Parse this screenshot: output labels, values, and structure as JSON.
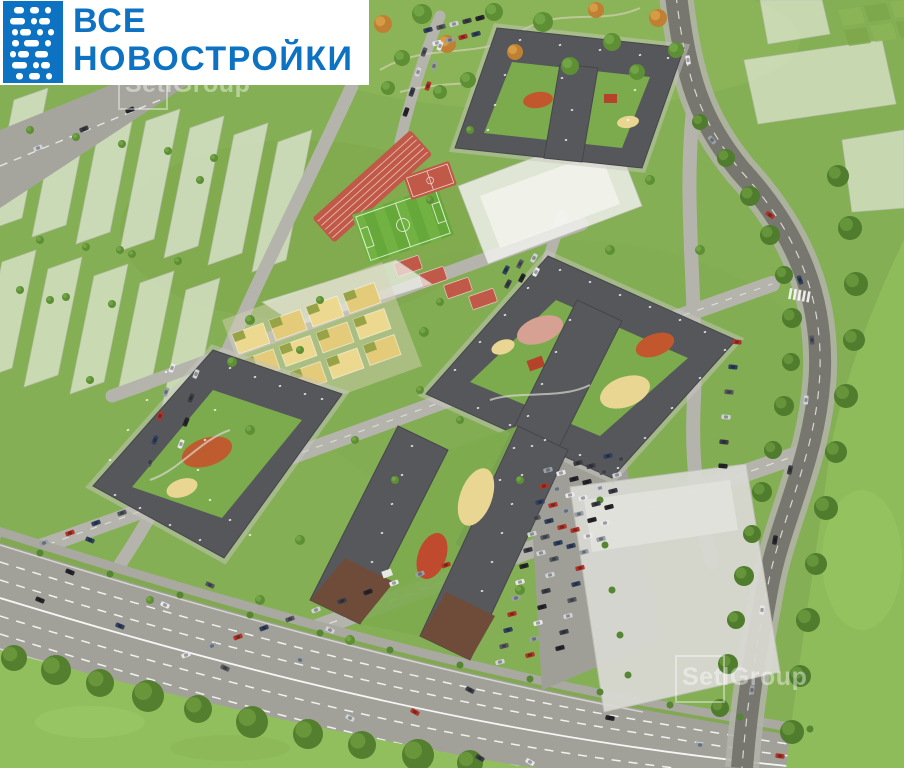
{
  "header_logo": {
    "line1": "ВСЕ",
    "line2": "НОВОСТРОЙКИ",
    "icon": "pixel-mosaic-building-icon",
    "text_color": "#0e72c3",
    "icon_bg": "#0e72c3",
    "banner_bg": "#ffffff"
  },
  "watermark": {
    "text": "SetlGroup",
    "color": "#ffffff",
    "opacity": 0.4,
    "instances": [
      "top-left-partially-behind-banner",
      "bottom-right"
    ]
  },
  "scene": {
    "type": "aerial-3d-architectural-render",
    "subject": "residential-district-masterplan",
    "palette": {
      "grass": "#85af54",
      "lawn": "#92bf5e",
      "street": "#b4b4ac",
      "highway": "#a1a199",
      "asphalt_dark": "#77776f",
      "roof": "#56575b",
      "ghost_building": "#f4f4f0",
      "sports_red": "#c05947",
      "pitch_green": "#66a83a",
      "sand": "#e9d693",
      "playground_orange": "#c2572e",
      "playground_red": "#b5432c",
      "tree": "#5e8f35",
      "autumn_tree": "#c08034",
      "facade_brown": "#6f4c3a"
    },
    "features": [
      "north-courtyard-complex",
      "east-courtyard-complex",
      "west-courtyard-complex",
      "south-twin-slabs",
      "running-track",
      "football-pitch",
      "basketball-court",
      "sport-courts",
      "school-ghost-building",
      "kindergarten-playgrounds",
      "ghost-district-west",
      "ghost-blocks-northeast",
      "highway",
      "ring-road",
      "parking-lots",
      "mall-ghost-building"
    ]
  }
}
